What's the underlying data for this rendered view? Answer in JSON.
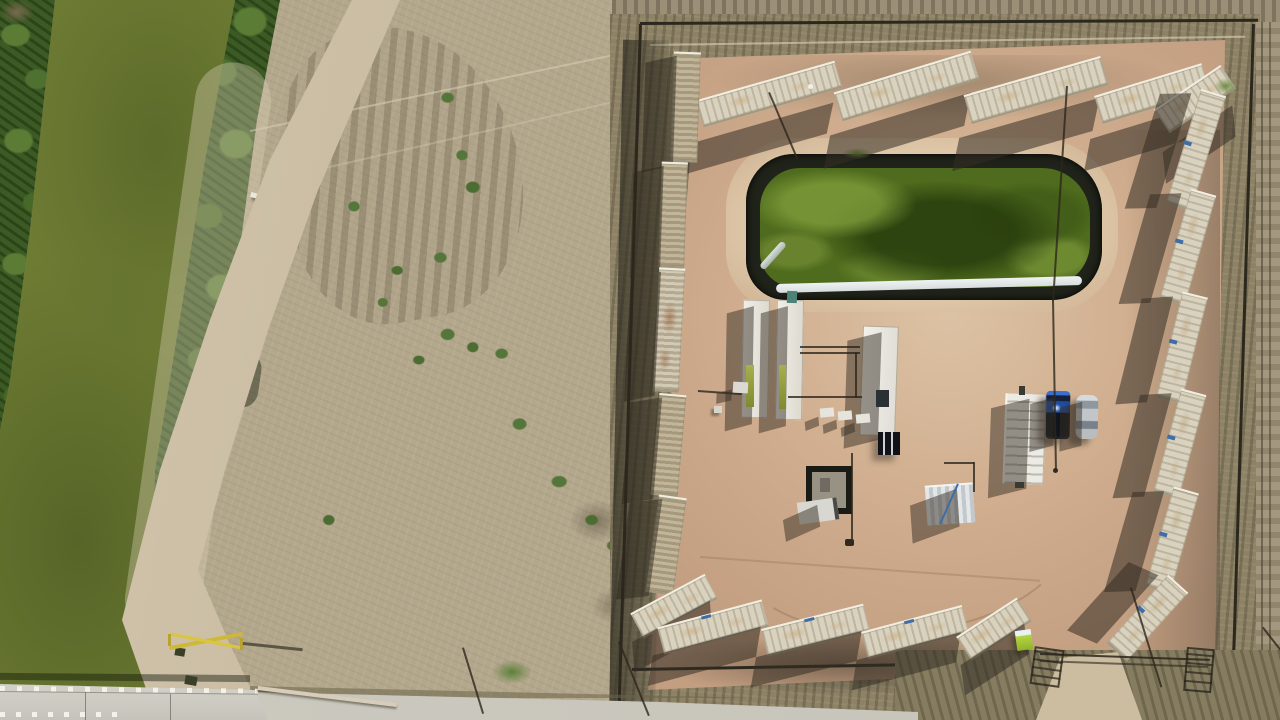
{
  "meta": {
    "image_type": "aerial-drone-photograph",
    "subject": "Top-down view of a fenced oil-and-gas well pad with a green lined containment pond, perimeter of shipping containers, equipment trailers and parked vehicles, bordered on the left by a green irrigation canal with dense bank vegetation, dirt roads, a concrete bridge and a paved road at the bottom"
  },
  "palette": {
    "scrub_base": "#b3a78c",
    "scrub_top": "#9b9077",
    "scrub_right": "#a3977d",
    "canal_water": "#6d7b33",
    "vegetation": "#3c5a24",
    "vegetation_light": "#5a7c35",
    "pad_dirt": "#cfac8d",
    "pad_light": "#dcc2a4",
    "berm_light": "#e0c9ab",
    "pond_liner": "#20231a",
    "pond_water": "#4f6b1d",
    "pond_algae_light": "#7c9c31",
    "pond_algae_dark": "#263a0c",
    "liner_silver": "#d7dddd",
    "container_cream": "#d9d2bf",
    "grass_ring": "#8d8266",
    "fence_dark": "#2c281e",
    "road_dirt": "#d2c5ac",
    "road_paved": "#c8c5bb",
    "bridge_concrete": "#d4d2ca",
    "truck_blue": "#1f4da0",
    "truck_bed_dark": "#10141c",
    "car_silver": "#c2c6c9",
    "equip_white": "#eceae5",
    "equip_teal": "#4e8278",
    "gate_yellow": "#d9c53e",
    "lime_green": "#b5d43e",
    "shed_silver": "#e3e7e8",
    "shed_blue": "#3f6da6",
    "shadow_dark": "rgba(52,46,36,0.55)"
  },
  "inventory": {
    "containers_top_row": 5,
    "containers_right_column": 6,
    "containers_left_column": 5,
    "containers_bottom_row": 5,
    "corner_containers": 3,
    "vehicles": [
      "blue-pickup-truck",
      "silver-sedan"
    ],
    "structures": [
      "containment-pond",
      "frac-tank-pair",
      "long-white-trailer",
      "stair-trailer",
      "corrugated-shed",
      "wellhead-cellar",
      "mini-trailer"
    ],
    "site_features": [
      "irrigation-canal",
      "concrete-bridge",
      "yellow-pipe-gate",
      "dirt-road",
      "paved-road",
      "perimeter-fence",
      "power-poles"
    ]
  }
}
